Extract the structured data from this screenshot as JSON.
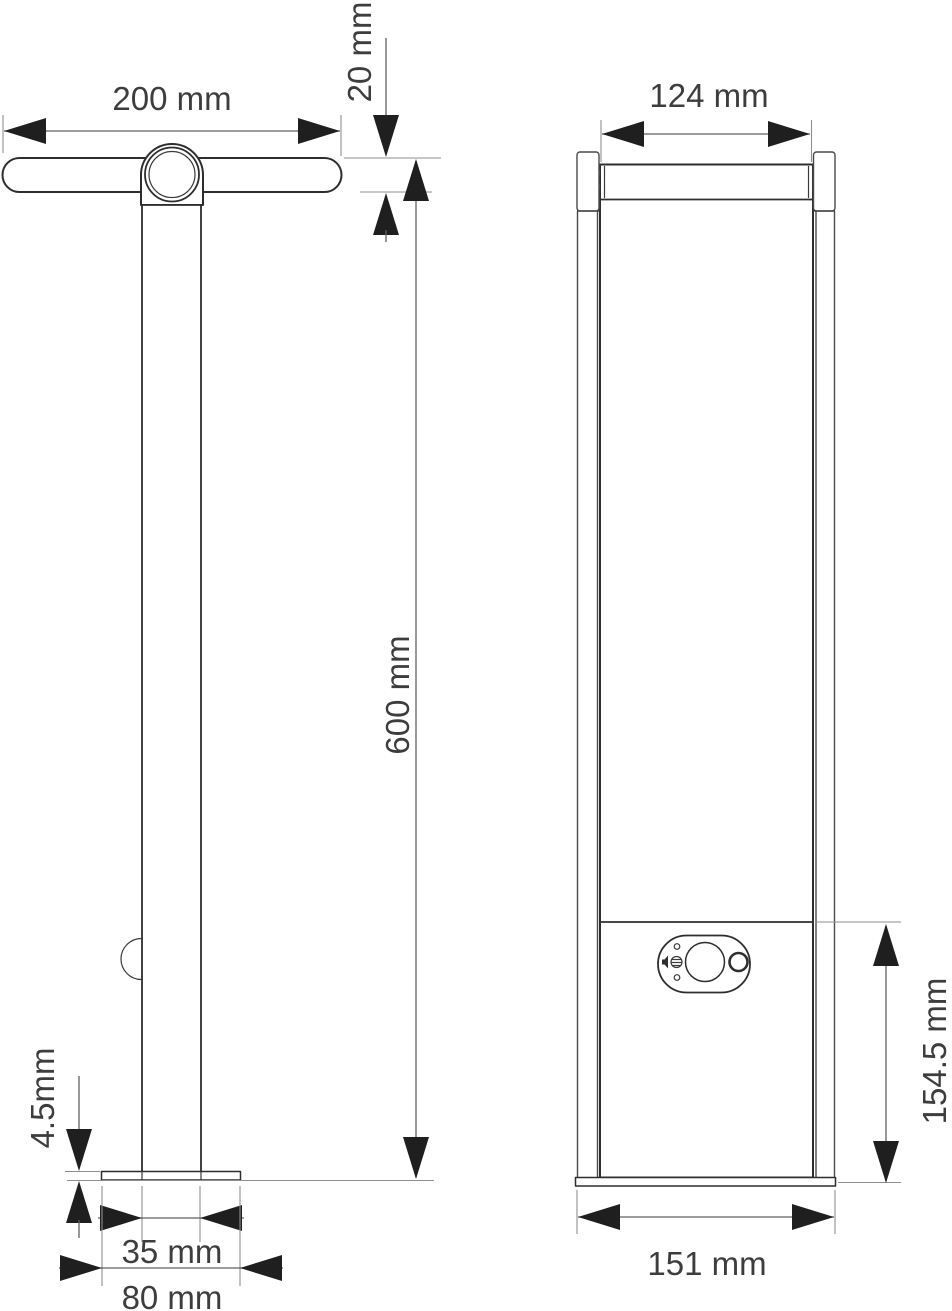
{
  "dimensions": {
    "side": {
      "head_width": "200 mm",
      "head_thickness": "20 mm",
      "overall_height": "600 mm",
      "base_plate_thickness": "4.5mm",
      "pole_width": "35 mm",
      "base_plate_width": "80 mm"
    },
    "front": {
      "head_width": "124 mm",
      "base_width": "151 mm",
      "control_box_height": "154.5 mm"
    }
  },
  "icons": {
    "sensor_panel": "pir-motion-sensor-panel",
    "speaker": "speaker-icon",
    "photocell": "photocell-button"
  },
  "colors": {
    "background": "#ffffff",
    "outline": "#2e2e2e",
    "dimension_line": "#606060",
    "extension_line": "#8f8f8f",
    "arrow": "#1f1f1f",
    "label_text": "#3d3d3d"
  }
}
